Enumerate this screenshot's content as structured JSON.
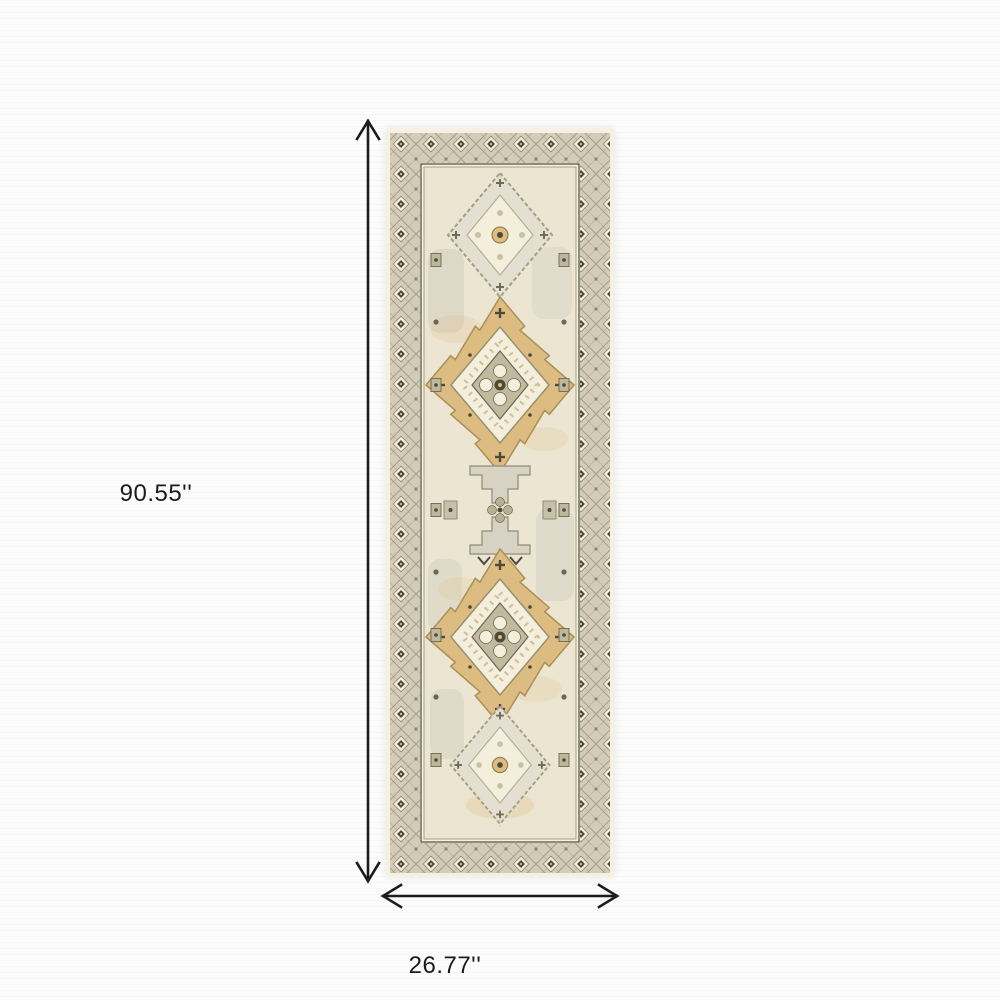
{
  "diagram": {
    "type": "product-dimensions",
    "subject": "Beige and ivory oriental medallion runner rug, top view",
    "height": {
      "label": "90.55''"
    },
    "width": {
      "label": "26.77''"
    }
  },
  "icons": {
    "height_arrow": "vertical double-headed measurement arrow",
    "width_arrow": "horizontal double-headed measurement arrow"
  },
  "palette": {
    "ink": "#1c1c1c",
    "bg": "#fcfcfc",
    "rug-edge": "#f6f0e0",
    "rug-border-bg": "#d3ccb8",
    "rug-lattice": "#a89f85",
    "rug-motif-dark": "#4e4a39",
    "rug-field": "#ece5d1",
    "rug-ivory": "#f4eedd",
    "rug-gold": "#ddbc82",
    "rug-gold-deep": "#a98f58",
    "rug-grey": "#d6d2c4",
    "rug-grey-green": "#b9b194",
    "rug-grey-deep": "#908c77"
  }
}
